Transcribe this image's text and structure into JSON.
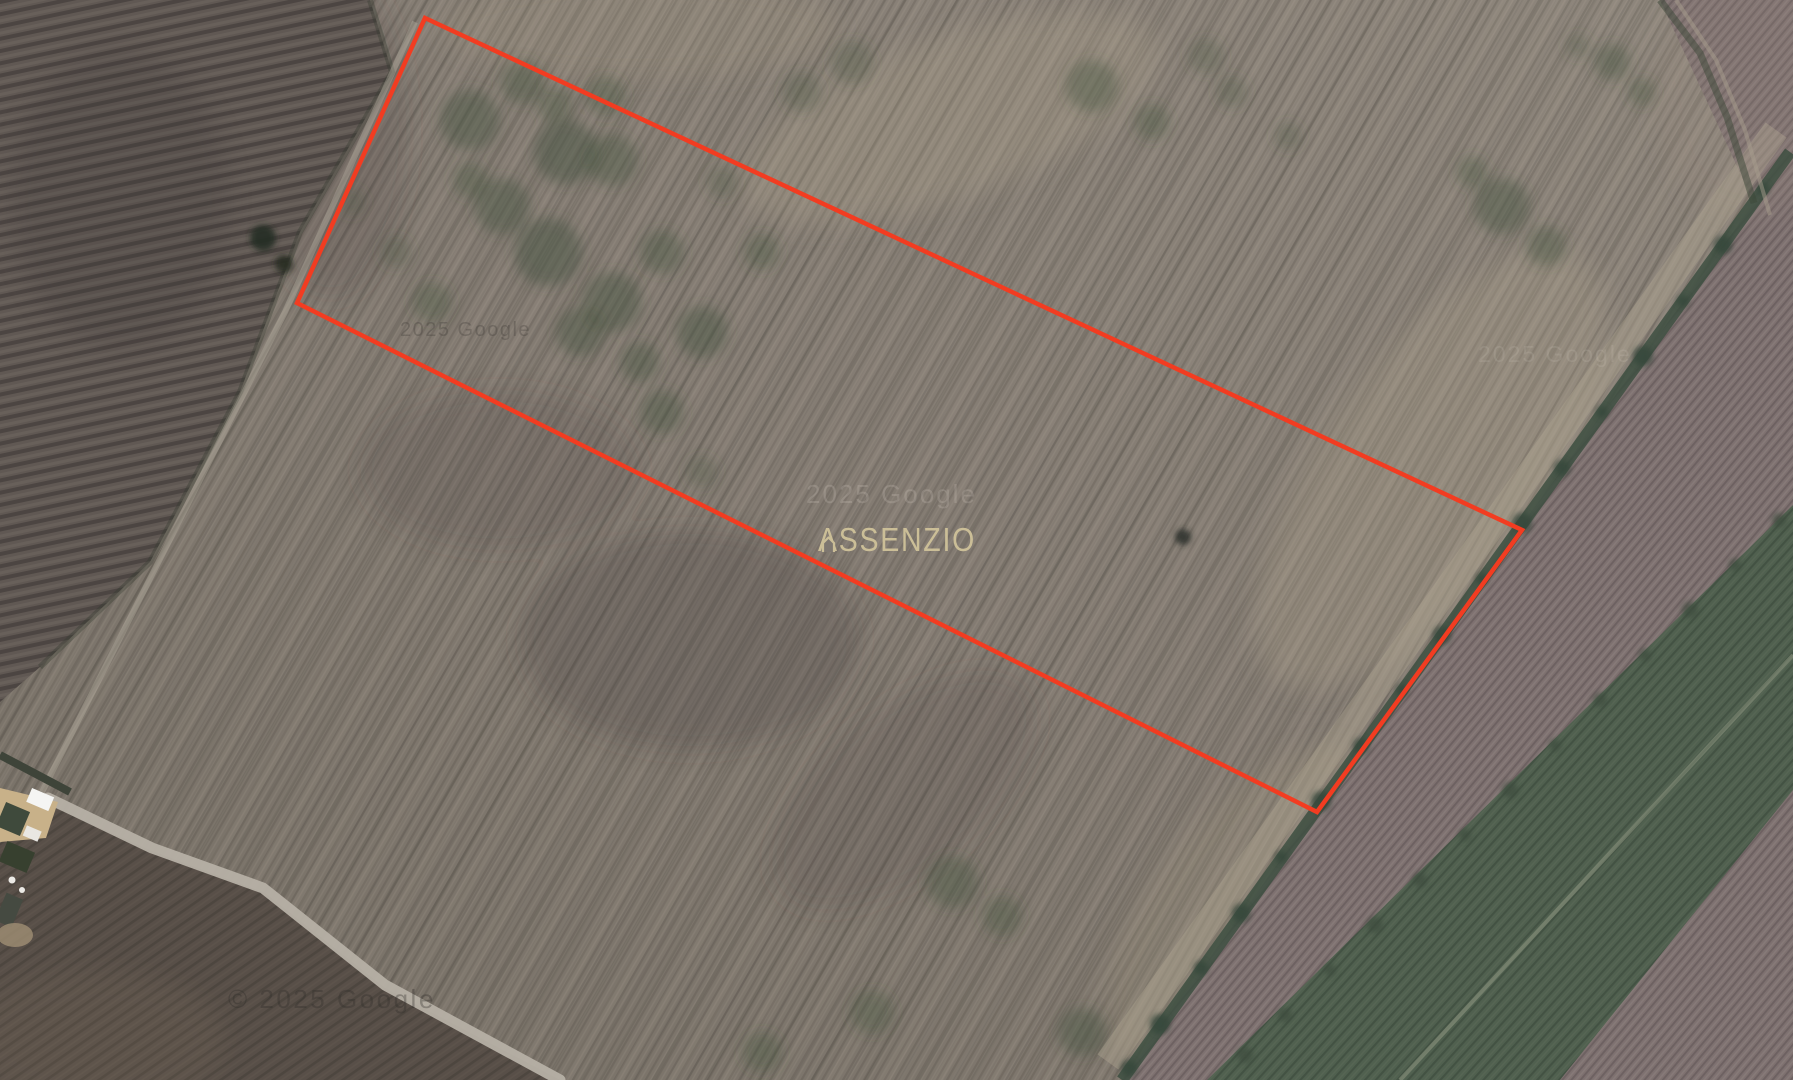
{
  "map": {
    "view_type": "satellite",
    "branding": {
      "logo_text": "ASSENZIO"
    },
    "attributions": {
      "tile_upper_left": "2025 Google",
      "tile_center": "2025 Google",
      "tile_right": "2025 Google",
      "copyright_bottom": "© 2025 Google"
    },
    "parcel": {
      "points_px": "425,18 1522,530 1317,812 297,303",
      "boundary_color": "#f23c21"
    },
    "roads": {
      "main_path": "M 48 798 L 152 848 L 263 888 L 385 985 L 560 1080",
      "track_path": "M 42 792 L 285 312 L 415 22"
    }
  }
}
